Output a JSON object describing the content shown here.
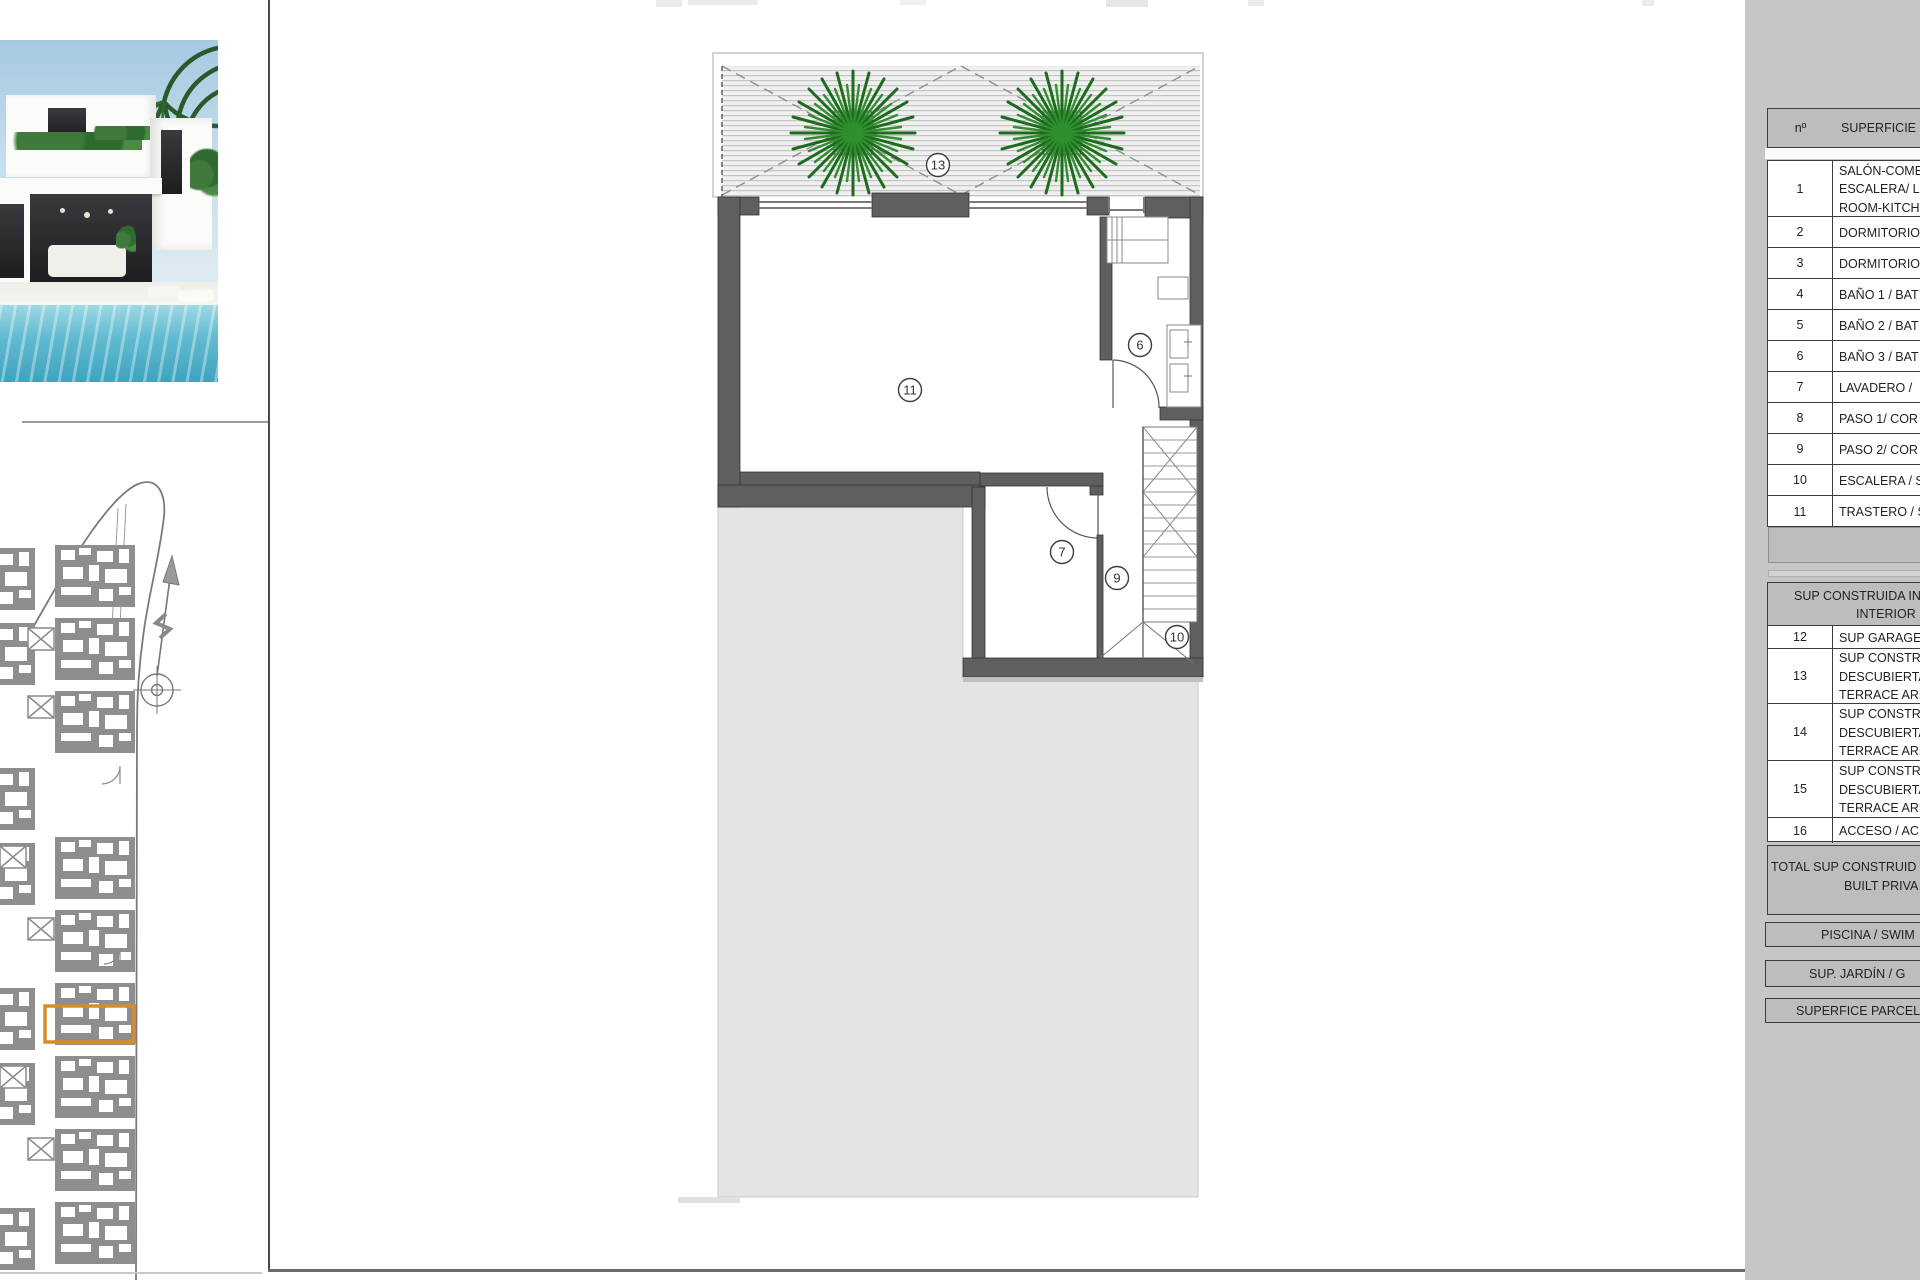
{
  "panel_table": {
    "header": {
      "no": "nº",
      "title": "SUPERFICIE Ú"
    },
    "rows": [
      {
        "no": "1",
        "lines": [
          "SALÓN-COME",
          "ESCALERA/ LI",
          "ROOM-KITCH"
        ]
      },
      {
        "no": "2",
        "lines": [
          "DORMITORIO"
        ]
      },
      {
        "no": "3",
        "lines": [
          "DORMITORIO"
        ]
      },
      {
        "no": "4",
        "lines": [
          "BAÑO 1 / BAT"
        ]
      },
      {
        "no": "5",
        "lines": [
          "BAÑO 2 / BAT"
        ]
      },
      {
        "no": "6",
        "lines": [
          "BAÑO 3 / BAT"
        ]
      },
      {
        "no": "7",
        "lines": [
          "LAVADERO /"
        ]
      },
      {
        "no": "8",
        "lines": [
          "PASO 1/ COR"
        ]
      },
      {
        "no": "9",
        "lines": [
          "PASO 2/ COR"
        ]
      },
      {
        "no": "10",
        "lines": [
          "ESCALERA / S"
        ]
      },
      {
        "no": "11",
        "lines": [
          "TRASTERO / S"
        ]
      }
    ],
    "section2": {
      "header_line1": "SUP CONSTRUIDA IN",
      "header_line2": "INTERIOR",
      "rows": [
        {
          "no": "12",
          "lines": [
            "SUP GARAGE,"
          ]
        },
        {
          "no": "13",
          "lines": [
            "SUP CONSTRU",
            "DESCUBIERTA",
            "TERRACE ARE"
          ]
        },
        {
          "no": "14",
          "lines": [
            "SUP CONSTRU",
            "DESCUBIERTA",
            "TERRACE ARE"
          ]
        },
        {
          "no": "15",
          "lines": [
            "SUP CONSTRU",
            "DESCUBIERTA",
            "TERRACE ARE"
          ]
        },
        {
          "no": "16",
          "lines": [
            "ACCESO / AC"
          ]
        }
      ]
    },
    "total": {
      "line1": "TOTAL SUP CONSTRUID",
      "line2": "BUILT PRIVA"
    },
    "summary": [
      {
        "label": "PISCINA / SWIM"
      },
      {
        "label": "SUP. JARDÍN / G"
      },
      {
        "label": "SUPERFICE PARCEL"
      }
    ]
  },
  "floorplan": {
    "labels": {
      "terrace": "13",
      "storage": "11",
      "bathroom": "6",
      "laundry": "7",
      "corridor": "9",
      "stairs": "10"
    }
  },
  "colors": {
    "accent_orange": "#d98a2b",
    "wall_gray": "#5f5f5f",
    "panel_gray": "#c6c6c6",
    "ground_gray": "#e4e4e4",
    "palm_green": "#1e6b1e",
    "pool_blue": "#3fa3bf"
  }
}
